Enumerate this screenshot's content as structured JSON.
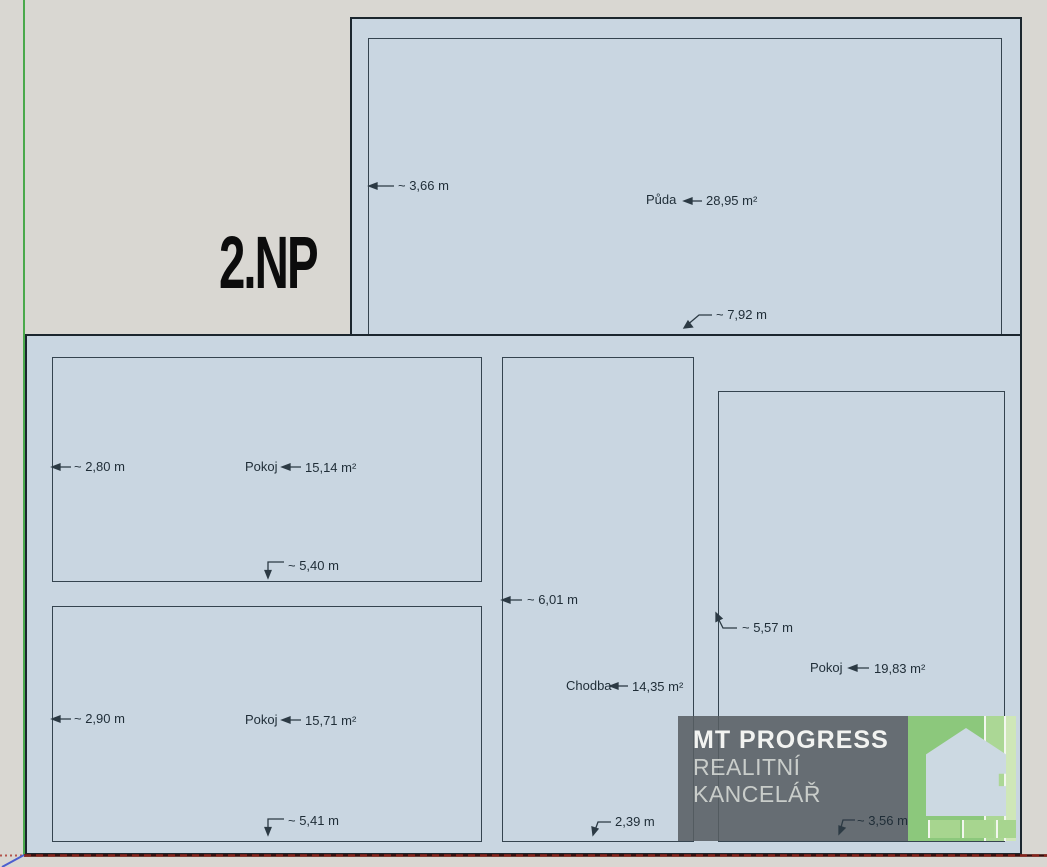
{
  "floor_title": "2.NP",
  "rooms": {
    "puda": {
      "name": "Půda",
      "area": "28,95 m²",
      "dim_height": "~ 3,66 m",
      "dim_width": "~ 7,92 m"
    },
    "pokoj_top_left": {
      "name": "Pokoj",
      "area": "15,14 m²",
      "dim_height": "~ 2,80 m",
      "dim_width": "~ 5,40 m"
    },
    "pokoj_bottom_left": {
      "name": "Pokoj",
      "area": "15,71 m²",
      "dim_height": "~ 2,90 m",
      "dim_width": "~ 5,41 m"
    },
    "chodba": {
      "name": "Chodba",
      "area": "14,35 m²",
      "dim_height": "~ 6,01 m",
      "dim_width": "2,39 m"
    },
    "pokoj_right": {
      "name": "Pokoj",
      "area": "19,83 m²",
      "dim_height": "~ 5,57 m",
      "dim_width": "~ 3,56 m"
    }
  },
  "watermark": {
    "brand": "MT PROGRESS",
    "subtitle": "REALITNÍ KANCELÁŘ"
  },
  "colors": {
    "background": "#d9d7d2",
    "plan_fill": "#c9d6e1",
    "wall": "#1b262e",
    "inner_wall": "#35444f",
    "axis_green": "#4aa94c",
    "axis_red": "#6b1511",
    "axis_blue": "#4c5ecf",
    "watermark_bg": "#585e63",
    "watermark_green": "#8cc87c",
    "house_fill": "#ccd9e2"
  }
}
